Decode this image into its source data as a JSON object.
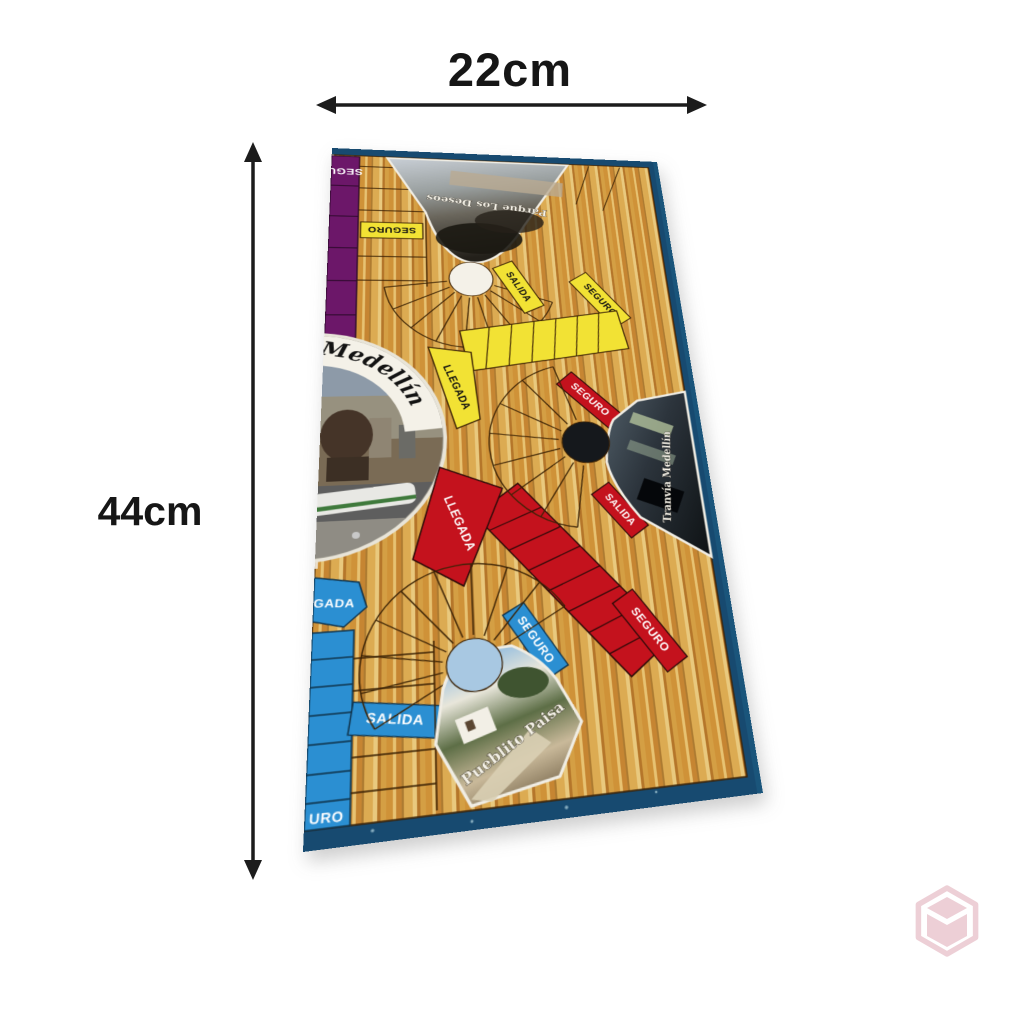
{
  "annotations": {
    "width_label": "22cm",
    "height_label": "44cm",
    "arrow_color": "#1c1c1c"
  },
  "board": {
    "border_color": "#174a70",
    "wood_color": "#d7a148",
    "center_title": "Medellín",
    "corner_photos": {
      "top": "Parque Los Deseos",
      "right": "Tranvía Medellín",
      "bottom": "Pueblito Paisa"
    },
    "zones": {
      "purple": {
        "color": "#6c1769",
        "seguro": "SEGU",
        "llegada": "LLEG"
      },
      "yellow": {
        "color": "#f2e234",
        "seguro_top": "SEGURO",
        "salida": "SALIDA",
        "seguro_right": "SEGURO",
        "llegada": "LLEGADA"
      },
      "red": {
        "color": "#c4121d",
        "seguro_top": "SEGURO",
        "salida": "SALIDA",
        "llegada": "LLEGADA",
        "seguro_bottom": "SEGURO"
      },
      "blue": {
        "color": "#2b8fd2",
        "llegada": "GADA",
        "seguro": "SEGURO",
        "salida": "SALIDA",
        "seguro_bottom": "URO"
      }
    }
  },
  "watermark": {
    "icon": "cube-logo",
    "color": "#eccdd4"
  }
}
